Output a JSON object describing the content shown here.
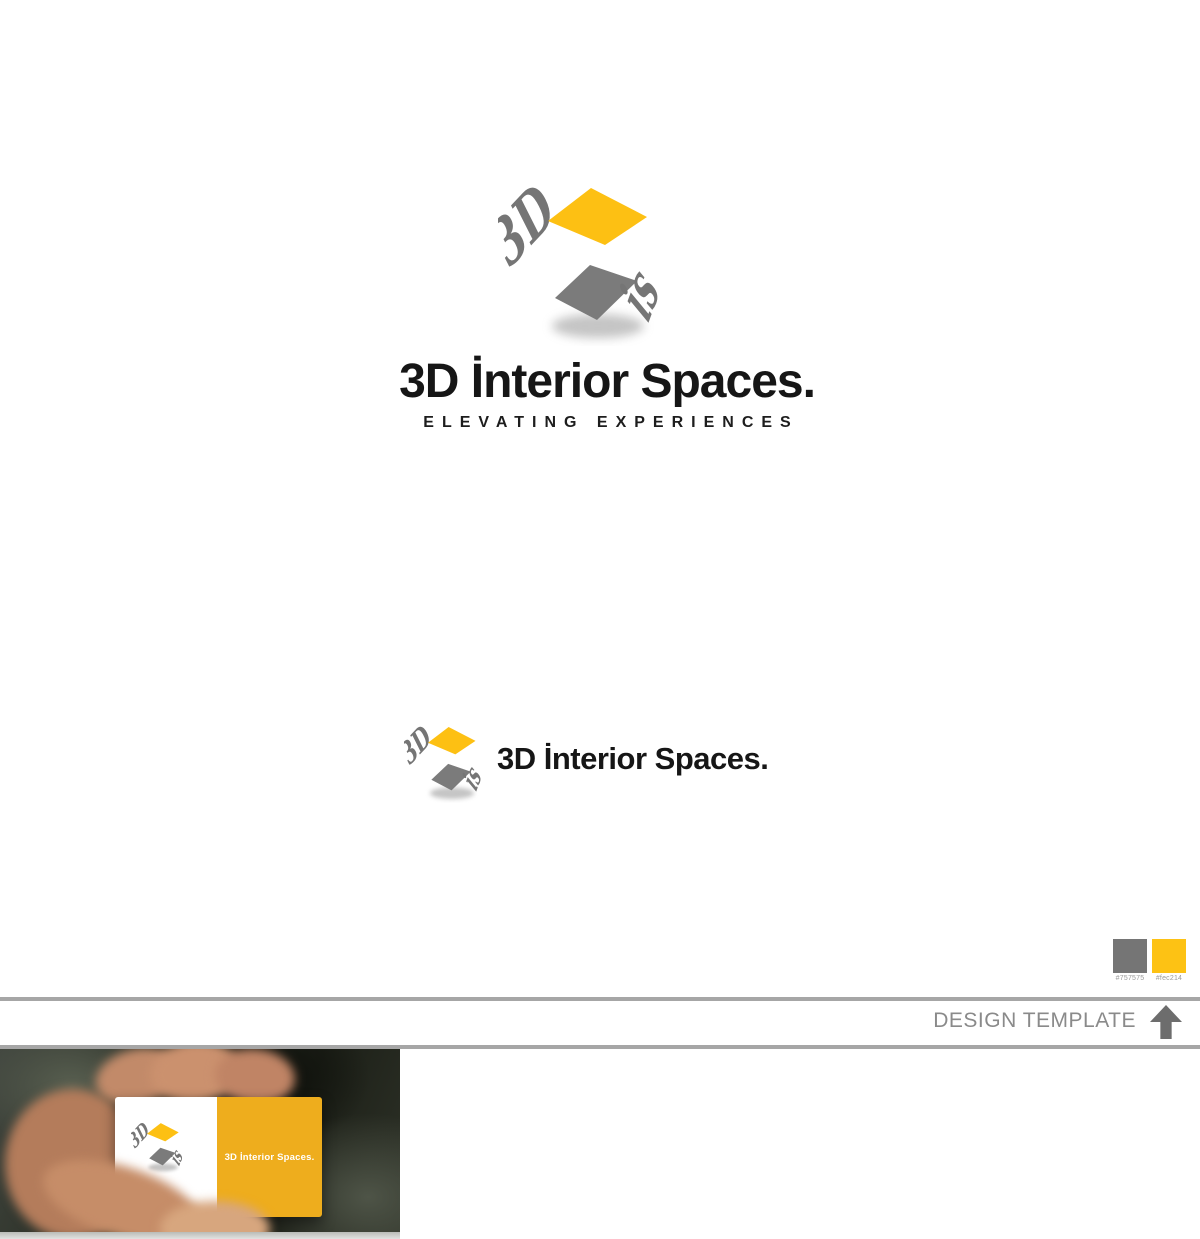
{
  "brand": {
    "mark": {
      "left_text": "3D",
      "right_text": "is",
      "gray": "#757575",
      "yellow": "#fdc214"
    },
    "title": "3D İnterior Spaces.",
    "tagline": "ELEVATING EXPERIENCES"
  },
  "secondary": {
    "title": "3D İnterior Spaces."
  },
  "palette": {
    "swatches": [
      {
        "label": "#757575",
        "color": "#757575"
      },
      {
        "label": "#fec214",
        "color": "#fec214"
      }
    ]
  },
  "template_bar": {
    "label": "DESIGN TEMPLATE"
  },
  "business_card": {
    "title": "3D İnterior Spaces."
  }
}
